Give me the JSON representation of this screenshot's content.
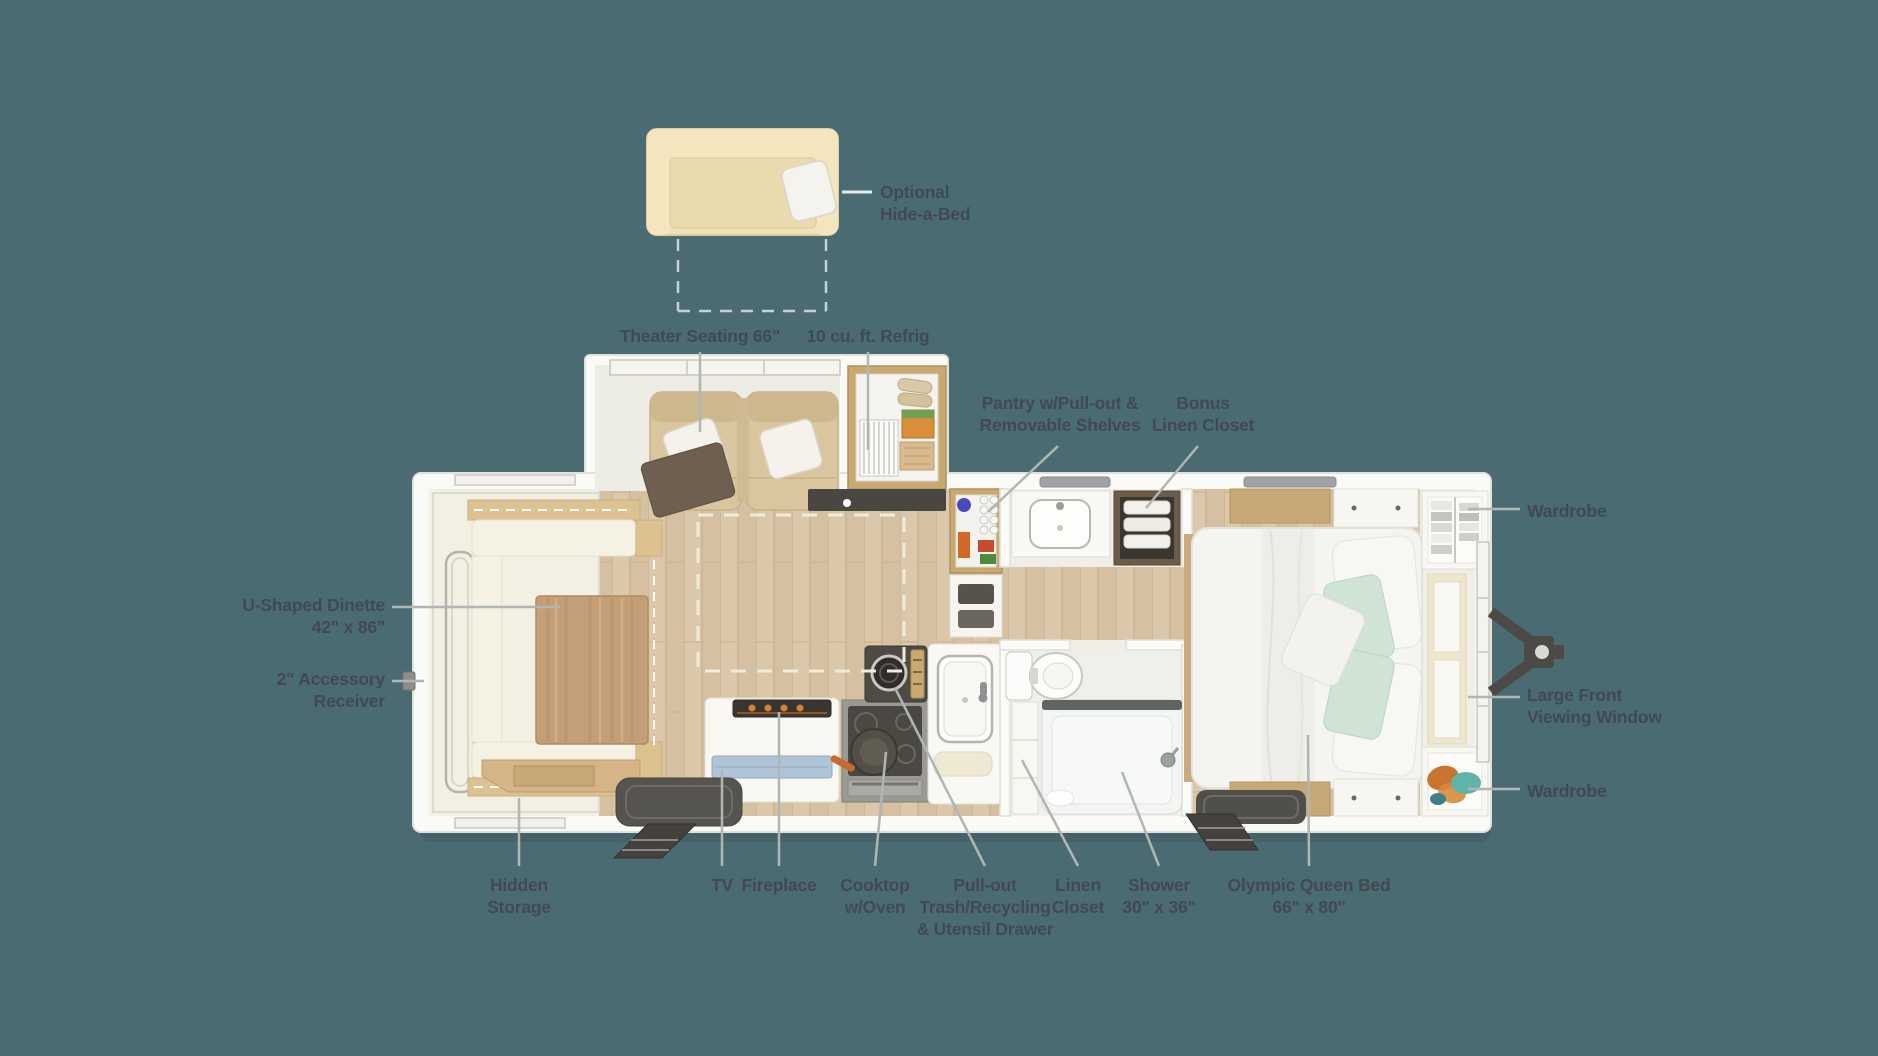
{
  "colors": {
    "background": "#4B6B73",
    "label_text": "#414A50",
    "leader_line": "#AFB6B4",
    "body_white": "#FAFAF6",
    "floor_wood": "#DBC7AA",
    "slide_floor_cream": "#F2EFE3",
    "cabinet_wood": "#C9A96F",
    "table_wood": "#C49E76",
    "cushion_cream": "#F6F2E3",
    "seat_tan": "#D9C59E",
    "sofa_tan": "#F0E1B6",
    "mint_pillow": "#CFE4D4",
    "bedding_white": "#F4F4F1",
    "dark_fixture": "#4B4843",
    "flame_orange": "#D3832F",
    "tv_screen_blue": "#AFC4D6",
    "clothes_orange": "#C8742F",
    "clothes_teal": "#5FB3A8",
    "towel_white": "#F2F1EC",
    "hitch_gray": "#4C4A46"
  },
  "labels": {
    "optional_hide_a_bed": "Optional\nHide-a-Bed",
    "theater_seating": "Theater Seating 66\"",
    "refrigerator": "10 cu. ft. Refrig",
    "pantry": "Pantry w/Pull-out &\nRemovable Shelves",
    "bonus_linen_closet": "Bonus\nLinen Closet",
    "wardrobe_top": "Wardrobe",
    "u_shaped_dinette": "U-Shaped Dinette\n42\" x 86\"",
    "accessory_receiver": "2\" Accessory\nReceiver",
    "large_front_viewing_window": "Large Front\nViewing Window",
    "wardrobe_bottom": "Wardrobe",
    "hidden_storage": "Hidden\nStorage",
    "tv": "TV",
    "fireplace": "Fireplace",
    "cooktop": "Cooktop\nw/Oven",
    "pull_out_trash": "Pull-out\nTrash/Recycling\n& Utensil Drawer",
    "linen_closet": "Linen\nCloset",
    "shower": "Shower\n30\" x 36\"",
    "olympic_queen_bed": "Olympic Queen Bed\n66\" x 80\""
  }
}
